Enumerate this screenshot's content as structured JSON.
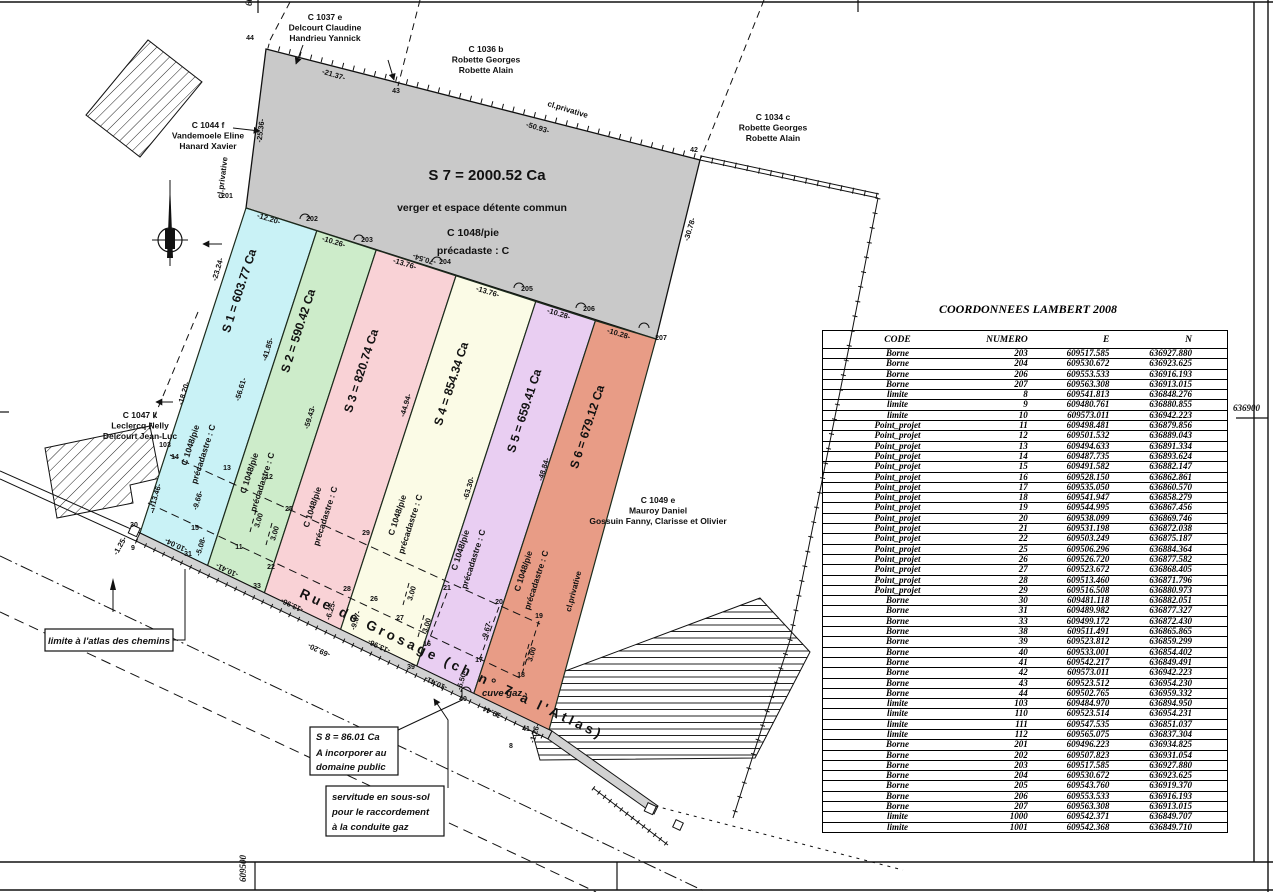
{
  "plan": {
    "street": "Rue de Grosage (ch n° 7 à l'Atlas)",
    "cl_privative": "cl.privative",
    "grid": {
      "right": "636900",
      "bottom": "609500",
      "top": "609500"
    },
    "s7": {
      "area": "S 7 = 2000.52 Ca",
      "sub1": "verger et espace détente commun",
      "sub2": "C 1048/pie",
      "sub3": "précadaste : C"
    },
    "parcels": [
      {
        "label": "S 1 = 603.77 Ca",
        "color": "#c9f2f6",
        "sub1": "C 1048/pie",
        "sub2": "précadastre : C"
      },
      {
        "label": "S 2 = 590.42 Ca",
        "color": "#cdecca",
        "sub1": "C 1048/pie",
        "sub2": "précadastre : C"
      },
      {
        "label": "S 3 = 820.74 Ca",
        "color": "#f9d2d6",
        "sub1": "C 1048/pie",
        "sub2": "précadastre : C"
      },
      {
        "label": "S 4 = 854.34 Ca",
        "color": "#fbfbe6",
        "sub1": "C 1048/pie",
        "sub2": "précadastre : C"
      },
      {
        "label": "S 5 = 659.41 Ca",
        "color": "#e9cef2",
        "sub1": "C 1048/pie",
        "sub2": "précadastre : C"
      },
      {
        "label": "S 6 = 679.12 Ca",
        "color": "#e89c86",
        "sub1": "C 1048/pie",
        "sub2": "précadastre : C"
      }
    ],
    "neighbors": [
      {
        "lines": [
          "C 1037 e",
          "Delcourt Claudine",
          "Handrieu Yannick"
        ]
      },
      {
        "lines": [
          "C 1036 b",
          "Robette Georges",
          "Robette Alain"
        ]
      },
      {
        "lines": [
          "C 1034 c",
          "Robette Georges",
          "Robette Alain"
        ]
      },
      {
        "lines": [
          "C 1044 f",
          "Vandemoele Eline",
          "Hanard Xavier"
        ]
      },
      {
        "lines": [
          "C 1047 k",
          "Leclercq Nelly",
          "Delcourt Jean-Luc"
        ]
      },
      {
        "lines": [
          "C 1049 e",
          "Mauroy Daniel",
          "Gossuin Fanny, Clarisse et Olivier"
        ]
      }
    ],
    "notes": {
      "limite": "limite à l'atlas des chemins",
      "s8": [
        "S 8 = 86.01 Ca",
        "A incorporer au",
        "domaine public"
      ],
      "servitude": [
        "servitude en sous-sol",
        "pour le raccordement",
        "à la conduite gaz"
      ],
      "cuve": "cuve gaz"
    },
    "dimensions": [
      "-21.37-",
      "-50.93-",
      "-25.36-",
      "-12.20-",
      "-10.26-",
      "-13.76-",
      "-70.54-",
      "-13.76-",
      "-10.28-",
      "-10.28-",
      "-30.78-",
      "-23.24-",
      "-18.20-",
      "-13.46-",
      "-41.85-",
      "-56.61-",
      "-59.43-",
      "-44.94-",
      "-63.30-",
      "-48.84-",
      "-9.66-",
      "-5.08-",
      "-9.67-",
      "-6.25-",
      "-9.67-",
      "-6.50-",
      "-10.04-",
      "-10.41-",
      "-13.96-",
      "-69.20-",
      "-13.96-",
      "-10.41-",
      "-10.44-",
      "-1.25-",
      "-1.26-",
      "3.00",
      "3.00",
      "3.00",
      "3.00",
      "3.00"
    ],
    "points": [
      "44",
      "43",
      "42",
      "201",
      "202",
      "203",
      "204",
      "205",
      "206",
      "207",
      "103",
      "14",
      "13",
      "12",
      "7",
      "15",
      "9",
      "30",
      "31",
      "11",
      "22",
      "33",
      "25",
      "29",
      "28",
      "26",
      "27",
      "21",
      "20",
      "19",
      "16",
      "17",
      "18",
      "39",
      "40",
      "41",
      "8"
    ]
  },
  "table": {
    "title": "COORDONNEES LAMBERT 2008",
    "headers": [
      "CODE",
      "NUMERO",
      "E",
      "N"
    ],
    "rows": [
      [
        "Borne",
        "203",
        "609517.585",
        "636927.880"
      ],
      [
        "Borne",
        "204",
        "609530.672",
        "636923.625"
      ],
      [
        "Borne",
        "206",
        "609553.533",
        "636916.193"
      ],
      [
        "Borne",
        "207",
        "609563.308",
        "636913.015"
      ],
      [
        "limite",
        "8",
        "609541.813",
        "636848.276"
      ],
      [
        "limite",
        "9",
        "609480.761",
        "636880.855"
      ],
      [
        "limite",
        "10",
        "609573.011",
        "636942.223"
      ],
      [
        "Point_projet",
        "11",
        "609498.481",
        "636879.856"
      ],
      [
        "Point_projet",
        "12",
        "609501.532",
        "636889.043"
      ],
      [
        "Point_projet",
        "13",
        "609494.633",
        "636891.334"
      ],
      [
        "Point_projet",
        "14",
        "609487.735",
        "636893.624"
      ],
      [
        "Point_projet",
        "15",
        "609491.582",
        "636882.147"
      ],
      [
        "Point_projet",
        "16",
        "609528.150",
        "636862.861"
      ],
      [
        "Point_projet",
        "17",
        "609535.050",
        "636860.570"
      ],
      [
        "Point_projet",
        "18",
        "609541.947",
        "636858.279"
      ],
      [
        "Point_projet",
        "19",
        "609544.995",
        "636867.456"
      ],
      [
        "Point_projet",
        "20",
        "609538.099",
        "636869.746"
      ],
      [
        "Point_projet",
        "21",
        "609531.198",
        "636872.038"
      ],
      [
        "Point_projet",
        "22",
        "609503.249",
        "636875.187"
      ],
      [
        "Point_projet",
        "25",
        "609506.296",
        "636884.364"
      ],
      [
        "Point_projet",
        "26",
        "609526.720",
        "636877.582"
      ],
      [
        "Point_projet",
        "27",
        "609523.672",
        "636868.405"
      ],
      [
        "Point_projet",
        "28",
        "609513.460",
        "636871.796"
      ],
      [
        "Point_projet",
        "29",
        "609516.508",
        "636880.973"
      ],
      [
        "Borne",
        "30",
        "609481.118",
        "636882.051"
      ],
      [
        "Borne",
        "31",
        "609489.982",
        "636877.327"
      ],
      [
        "Borne",
        "33",
        "609499.172",
        "636872.430"
      ],
      [
        "Borne",
        "38",
        "609511.491",
        "636865.865"
      ],
      [
        "Borne",
        "39",
        "609523.812",
        "636859.299"
      ],
      [
        "Borne",
        "40",
        "609533.001",
        "636854.402"
      ],
      [
        "Borne",
        "41",
        "609542.217",
        "636849.491"
      ],
      [
        "Borne",
        "42",
        "609573.011",
        "636942.223"
      ],
      [
        "Borne",
        "43",
        "609523.512",
        "636954.230"
      ],
      [
        "Borne",
        "44",
        "609502.765",
        "636959.332"
      ],
      [
        "limite",
        "103",
        "609484.970",
        "636894.950"
      ],
      [
        "limite",
        "110",
        "609523.514",
        "636954.231"
      ],
      [
        "limite",
        "111",
        "609547.535",
        "636851.037"
      ],
      [
        "limite",
        "112",
        "609565.075",
        "636837.304"
      ],
      [
        "Borne",
        "201",
        "609496.223",
        "636934.825"
      ],
      [
        "Borne",
        "202",
        "609507.823",
        "636931.054"
      ],
      [
        "Borne",
        "203",
        "609517.585",
        "636927.880"
      ],
      [
        "Borne",
        "204",
        "609530.672",
        "636923.625"
      ],
      [
        "Borne",
        "205",
        "609543.760",
        "636919.370"
      ],
      [
        "Borne",
        "206",
        "609553.533",
        "636916.193"
      ],
      [
        "Borne",
        "207",
        "609563.308",
        "636913.015"
      ],
      [
        "limite",
        "1000",
        "609542.371",
        "636849.707"
      ],
      [
        "limite",
        "1001",
        "609542.368",
        "636849.710"
      ]
    ]
  }
}
